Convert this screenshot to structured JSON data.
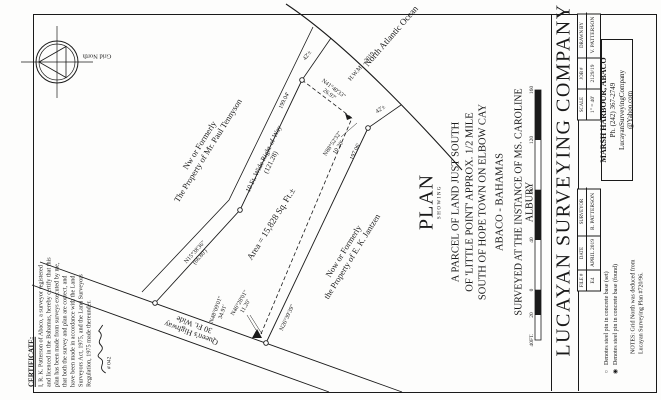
{
  "compass": {
    "label": "Grid North"
  },
  "certificate": {
    "heading": "CERTIFICATE:",
    "lines": [
      "I, R. K. Patterson of Abaco, a surveyor registered",
      "and licenced in the Bahamas, hereby certify that this",
      "plan has been made from surveys executed by me,",
      "that both the survey and plan are correct, and",
      "have been made in accordance with the Land",
      "Surveyors Act, 1975, and the Land Surveyors",
      "Regulation, 1975 made thereunder."
    ],
    "license_number": "# 042"
  },
  "drawing": {
    "ocean_label": "North Atlantic Ocean",
    "hwm_label": "H.W.M. - 2019",
    "tennyson_1": "Nw or Formerly",
    "tennyson_2": "The Property of Mr. Paul Tennyson",
    "jantzen_1": "Now or Formerly",
    "jantzen_2": "the Property of E. K. Jantzen",
    "area_label": "Area = 15,828 Sq. Ft.±",
    "row_label_1": "10 Ft. Wide Right-of-Way",
    "row_label_2": "(121.28)",
    "highway_1": "Queen's Highway",
    "highway_2": "30 Ft. Wide",
    "dim_42_left": "42'±",
    "dim_42_right": "42'±",
    "dim_199": "199.04'",
    "dim_197": "197.06'",
    "bearing_nw_1": "N15°38'36\"",
    "bearing_nw_2": "(66.80')",
    "bearing_se": "N26°39'39\"",
    "bearing_road_1": "N48°09'01\"",
    "bearing_road_2": "34.91'",
    "tie_top_1": "N41°40'33\"",
    "tie_top_2": "26.97'",
    "tie_short_1": "N88°52'32\"",
    "tie_short_2": "10.20'",
    "tie_bottom_1": "N46°28'01\"",
    "tie_bottom_2": "11.20'"
  },
  "title": {
    "plan": "PLAN",
    "showing": "SHOWING",
    "desc_1": "A PARCEL OF LAND JUST SOUTH",
    "desc_2": "OF 'LITTLE POINT' APPROX. 1/2 MILE",
    "desc_3": "SOUTH OF HOPE TOWN ON ELBOW CAY",
    "location": "ABACO - BAHAMAS",
    "surveyed": "SURVEYED AT THE INSTANCE OF MS. CAROLINE ALBURY"
  },
  "scalebar": {
    "labels": [
      "40FT.",
      "20",
      "0",
      "40",
      "80",
      "120",
      "160"
    ]
  },
  "titleblock": {
    "company": "LUCAYAN SURVEYING COMPANY",
    "address_1": "MARSH HARBOUR, ABACO",
    "address_2": "Ph. (242) 367-2749",
    "address_3": "LucayanSurveyingCompany",
    "address_4": "@Yahoo.com",
    "fields": [
      {
        "label": "DRAWN BY",
        "value": "V. PATTERSON"
      },
      {
        "label": "JOB #",
        "value": "2129/19"
      },
      {
        "label": "SCALE",
        "value": "1\" = 40'"
      },
      {
        "label": "SURVEYOR",
        "value": "R. PATTERSON"
      },
      {
        "label": "DATE",
        "value": "APRIL 2019"
      },
      {
        "label": "FILE #",
        "value": "E4"
      }
    ],
    "legend": [
      {
        "glyph": "○",
        "text": "Denotes steel pin in concrete base (set)"
      },
      {
        "glyph": "◉",
        "text": "Denotes steel pin in concrete base (found)"
      }
    ],
    "notes_1": "NOTES: Grid North was deduced from",
    "notes_2": "Lucayan Surveying Plan #720/96."
  }
}
